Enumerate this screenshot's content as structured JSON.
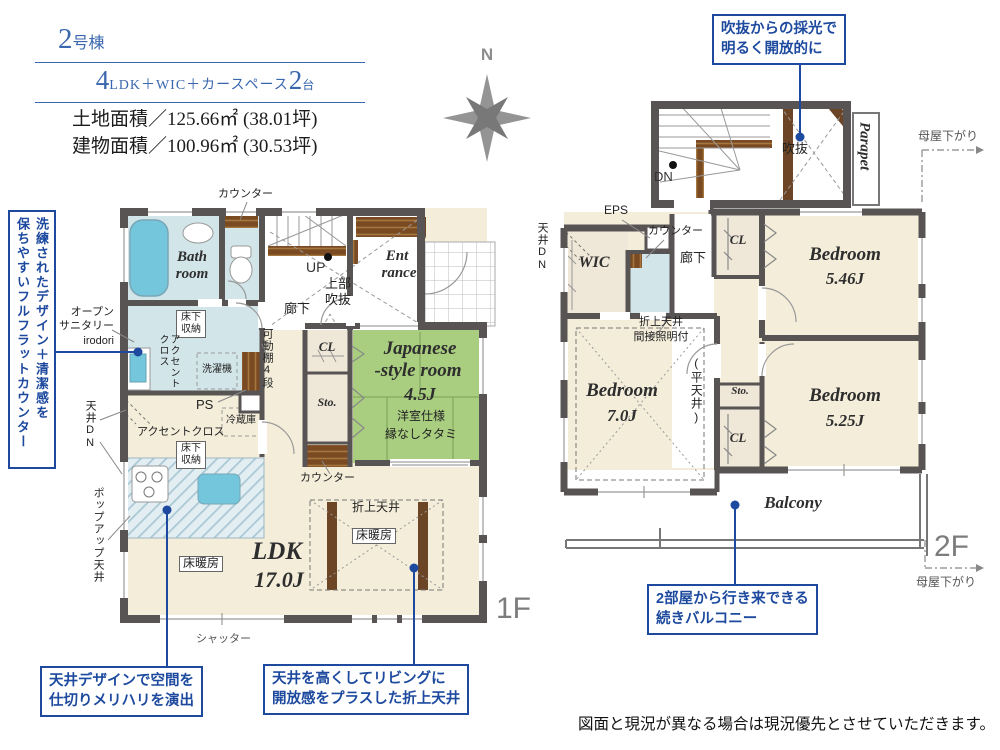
{
  "header": {
    "building_no_num": "2",
    "building_no_suffix": "号棟",
    "layout_num1": "4",
    "layout_mid": "LDK＋WIC＋カースペース",
    "layout_num2": "2",
    "layout_tail": "台",
    "land_area": "土地面積／125.66㎡ (38.01坪)",
    "building_area": "建物面積／100.96㎡ (30.53坪)"
  },
  "compass": {
    "north": "N"
  },
  "callouts": {
    "void_light": [
      "吹抜からの採光で",
      "明るく開放的に"
    ],
    "counter_vertical": [
      "洗練されたデザイン＋清潔感を",
      "保ちやすいフルフラットカウンター"
    ],
    "ceiling_zone": [
      "天井デザインで空間を",
      "仕切りメリハリを演出"
    ],
    "folded_ceiling": [
      "天井を高くしてリビングに",
      "開放感をプラスした折上天井"
    ],
    "balcony_link": [
      "2部屋から行き来できる",
      "続きバルコニー"
    ]
  },
  "shared": {
    "counter": "カウンター",
    "cl": "CL",
    "sto": "Sto.",
    "floor_heating": "床暖房",
    "underfloor_storage": "床下収納",
    "ceiling_dn": "天井DN",
    "moya_sagari": "母屋下がり",
    "hallway": "廊下",
    "folded_ceiling": "折上天井"
  },
  "f1": {
    "tag": "1F",
    "bath": [
      "Bath",
      "room"
    ],
    "up": "UP",
    "upper_void": [
      "上部",
      "吹抜"
    ],
    "entrance": [
      "Ent",
      "rance"
    ],
    "movable_shelf": "可動棚4段",
    "japanese": [
      "Japanese",
      "-style room",
      "4.5J",
      "洋室仕様",
      "縁なしタタミ"
    ],
    "accent_cloth_v": [
      "アクセント",
      "クロス"
    ],
    "washer": "洗濯機",
    "open_sanitary": [
      "オープン",
      "サニタリー",
      "irodori"
    ],
    "ps": "PS",
    "fridge": "冷蔵庫",
    "accent_cloth_h": "アクセントクロス",
    "popup_ceiling": "ポップアップ天井",
    "ldk": [
      "LDK",
      "17.0J"
    ],
    "shutter": "シャッター"
  },
  "f2": {
    "tag": "2F",
    "dn": "DN",
    "void": "吹抜",
    "parapet": "Parapet",
    "eps": "EPS",
    "wic": "WIC",
    "bed546": [
      "Bedroom",
      "5.46J"
    ],
    "bed70": [
      "Bedroom",
      "7.0J"
    ],
    "bed525": [
      "Bedroom",
      "5.25J"
    ],
    "folded_ceiling_note": [
      "折上天井",
      "間接照明付"
    ],
    "flat_ceiling": "(平天井)",
    "balcony": "Balcony"
  },
  "disclaimer": "図面と現況が異なる場合は現況優先とさせていただきます。",
  "colors": {
    "accent_blue": "#1d4a9e",
    "header_blue": "#3a67ae",
    "wall_gray": "#595454",
    "tatami_green": "#a9ce80",
    "wet_blue": "#d2e5e9",
    "fixture_blue": "#74c6dd",
    "wood_brown": "#7a4b22",
    "floor_cream": "#f3edda"
  }
}
